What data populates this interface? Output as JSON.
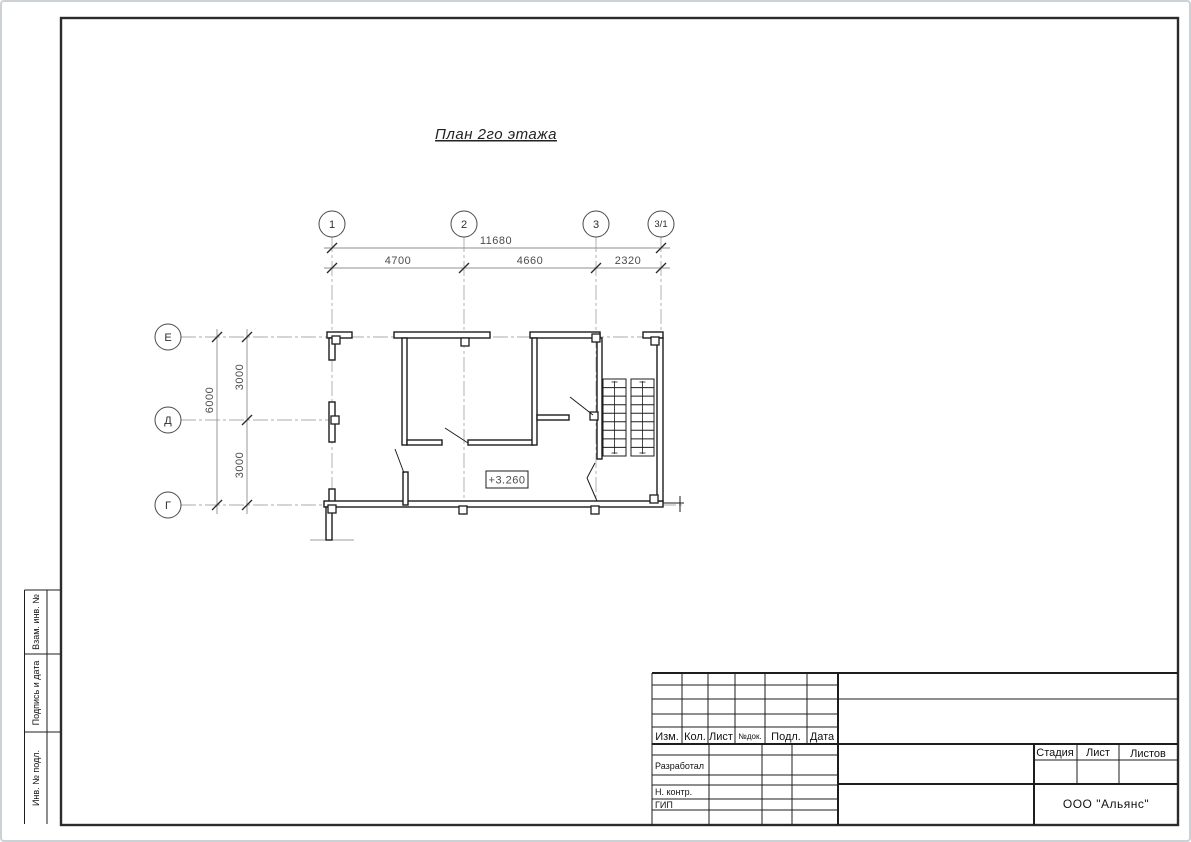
{
  "drawing": {
    "title": "План 2го этажа",
    "elevation_mark": "+3.260",
    "axes": {
      "vertical": [
        "1",
        "2",
        "3",
        "3/1"
      ],
      "horizontal": [
        "Е",
        "Д",
        "Г"
      ]
    },
    "dimensions": {
      "total_width": "11680",
      "width_spans": [
        "4700",
        "4660",
        "2320"
      ],
      "total_height": "6000",
      "height_spans": [
        "3000",
        "3000"
      ]
    }
  },
  "title_block": {
    "header_columns": [
      "Изм.",
      "Кол.",
      "Лист",
      "№док.",
      "Подл.",
      "Дата"
    ],
    "roles": [
      "Разработал",
      "Н. контр.",
      "ГИП"
    ],
    "stage_columns": [
      "Стадия",
      "Лист",
      "Листов"
    ],
    "company": "ООО \"Альянс\""
  },
  "side_labels": [
    "Взам. инв. №",
    "Подпись и дата",
    "Инв. № подл."
  ]
}
